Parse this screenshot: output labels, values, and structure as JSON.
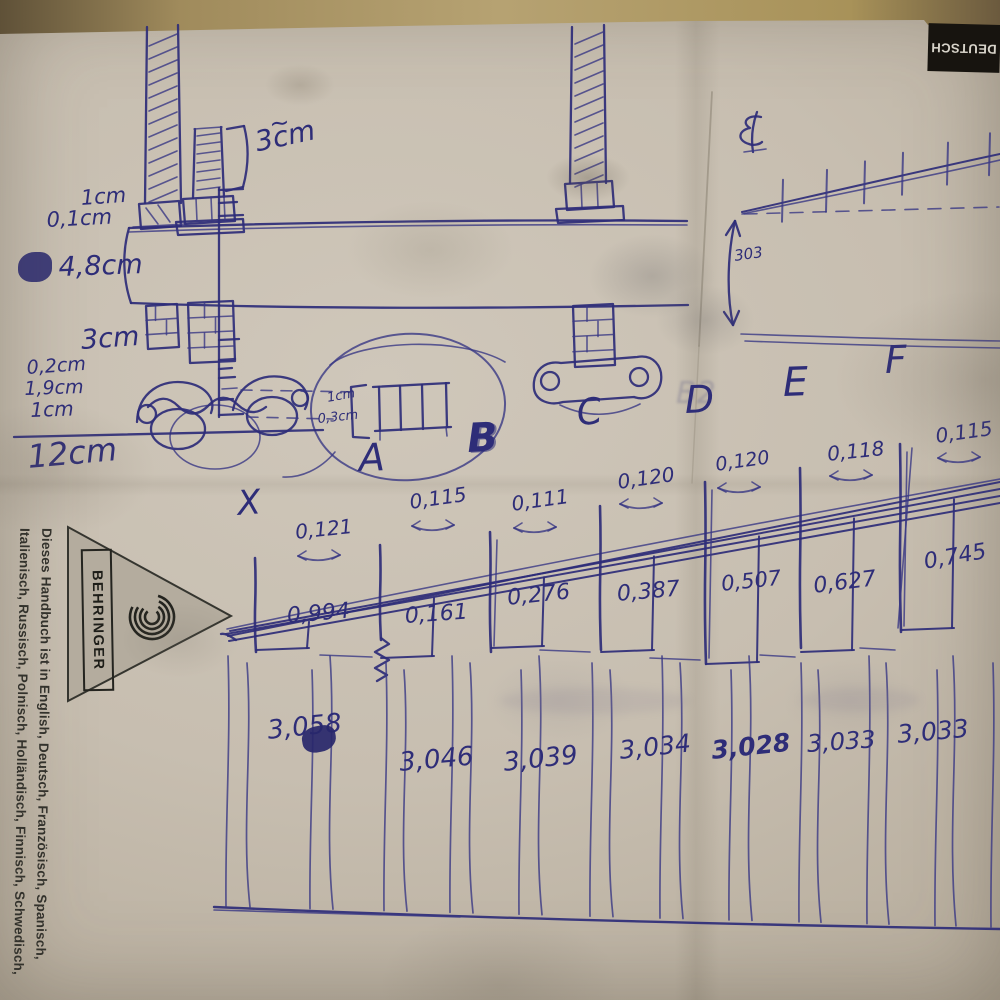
{
  "photo": {
    "paper_color": "#c7beb0",
    "table_color": "#a99467",
    "ink_color": "#2e2d78"
  },
  "printed": {
    "deutsch_tab": "DEUTSCH",
    "brand": "BEHRINGER",
    "margin_line1": "Dieses Handbuch ist in English, Deutsch, Französisch, Spanisch,",
    "margin_line2": "Italienisch, Russisch, Polnisch, Holländisch, Finnisch, Schwedisch,"
  },
  "upper_diagram": {
    "gap_tilde": "~",
    "gap_label": "3cm",
    "dims": [
      "1cm",
      "0,1cm",
      "4,8cm",
      "3cm",
      "0,2cm",
      "1,9cm",
      "1cm",
      "12cm"
    ],
    "detail_dim1": "1cm",
    "detail_dim2": "0,3cm",
    "height_label": "303",
    "ghost_label": "B2"
  },
  "lower_diagram": {
    "stations": [
      {
        "label": "X",
        "spacing": "0,121",
        "offset": "0,994",
        "bottom": "3,058"
      },
      {
        "label": "A",
        "spacing": "0,115",
        "offset": "0,161",
        "bottom": "3,046"
      },
      {
        "label": "B",
        "spacing": "0,111",
        "offset": "0,276",
        "bottom": "3,039"
      },
      {
        "label": "C",
        "spacing": "0,120",
        "offset": "0,387",
        "bottom": "3,034"
      },
      {
        "label": "D",
        "spacing": "0,120",
        "offset": "0,507",
        "bottom": "3,028"
      },
      {
        "label": "E",
        "spacing": "0,118",
        "offset": "0,627",
        "bottom": "3,033"
      },
      {
        "label": "F",
        "spacing": "0,115",
        "offset": "0,745",
        "bottom": "3,033"
      }
    ]
  }
}
